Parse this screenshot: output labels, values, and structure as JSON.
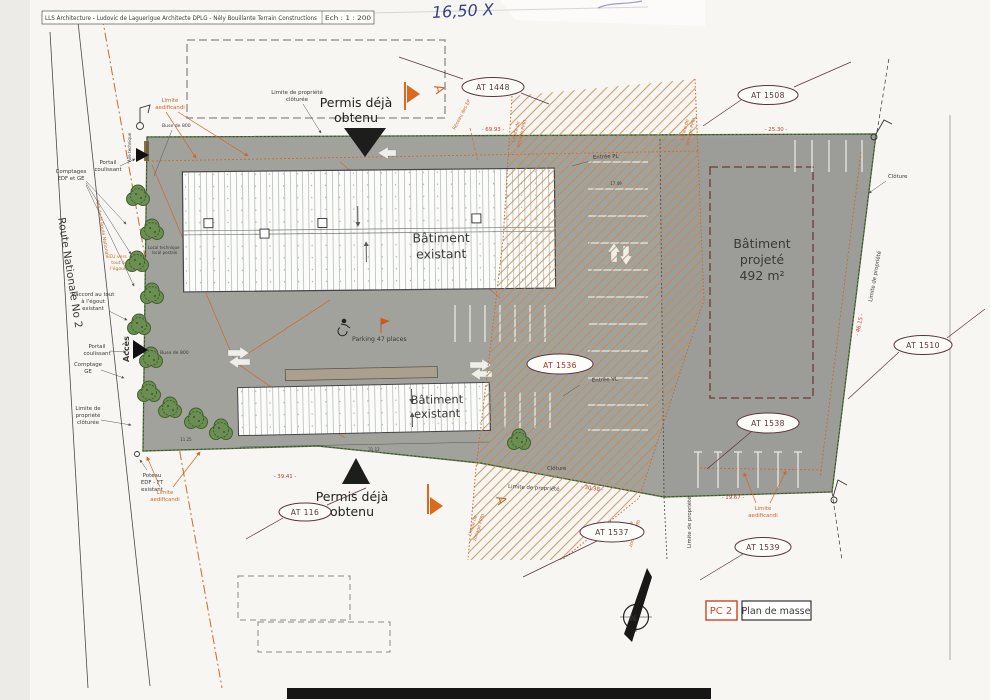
{
  "title_block": {
    "text": "LLS Architecture - Ludovic de Laguerigue Architecte DPLG -  Nély Bouillante  Terrain Constructions",
    "scale": "Ech : 1 : 200"
  },
  "handwriting": "16,50 X",
  "road": {
    "name": "Route Nationale No 2",
    "axis": "Axe de la Route Nationale"
  },
  "permit": {
    "l1": "Permis déjà",
    "l2": "obtenu"
  },
  "buildings": {
    "existing1": {
      "l1": "Bâtiment",
      "l2": "existant"
    },
    "existing2": {
      "l1": "Bâtiment",
      "l2": "existant"
    },
    "projected": {
      "l1": "Bâtiment",
      "l2": "projeté",
      "l3": "492 m²"
    }
  },
  "labels": {
    "comptages_l1": "Comptages",
    "comptages_l2": "EDF et GE",
    "portail_l1": "Portail",
    "portail_l2": "coulissant",
    "raccord_l1": "Raccord au tout",
    "raccord_l2": "à l'égout",
    "raccord_l3": "existant",
    "eu_l1": "EU vers",
    "eu_l2": "tout à",
    "eu_l3": "l'égout",
    "buse": "Buse de 800",
    "acces": "Accès",
    "comptage_ge_l1": "Comptage",
    "comptage_ge_l2": "GE",
    "aire_technique": "Aire technique",
    "local_l1": "Local technique",
    "local_l2": "local postale",
    "lpc_l1": "Limite de",
    "lpc_l2": "propriété",
    "lpc_l3": "clôturée",
    "lpc_top_l1": "Limite de propriété",
    "lpc_top_l2": "clôturée",
    "poteau_l1": "Poteau",
    "poteau_l2": "EDF - FT",
    "poteau_l3": "existant",
    "aedificandi_l1": "Limite",
    "aedificandi_l2": "aedificandi",
    "zonage_l1": "Limite de",
    "zonage_l2": "zonage PPRI",
    "reseau_ep": "Réseau des EP",
    "parking": "Parking 47 places",
    "entree_pl": "Entrée PL",
    "entree_vl": "Entrée VL",
    "cloture": "Clôture",
    "limite_propriete": "Limite de propriété",
    "section": "A",
    "north": "N"
  },
  "refs": {
    "at1448": "AT 1448",
    "at1508": "AT 1508",
    "at1510": "AT 1510",
    "at1536": "AT 1536",
    "at116": "AT 116",
    "at1537": "AT 1537",
    "at1538": "AT 1538",
    "at1539": "AT 1539"
  },
  "dims": {
    "top": "- 69.93 -",
    "topright": "- 25.30 -",
    "right": "- 46.15 -",
    "bottomleft": "- 39.41 -",
    "bottommid": "- 30.38 -",
    "bottomright": "- 19.67 -",
    "d1125": "11.25",
    "d3112": "31.12",
    "d1749": "17.49"
  },
  "legend": {
    "pc": "PC 2",
    "plan": "Plan de masse"
  },
  "colors": {
    "paper": "#f7f6f2",
    "parcel": "#a2a29d",
    "hatch": "#c58a4f",
    "orange": "#c96a2e",
    "red": "#c23b2e",
    "maroon": "#5a3340",
    "green": "#5c7d44",
    "ink": "#3a3a3a",
    "blue_pen": "#3b3e8c"
  }
}
